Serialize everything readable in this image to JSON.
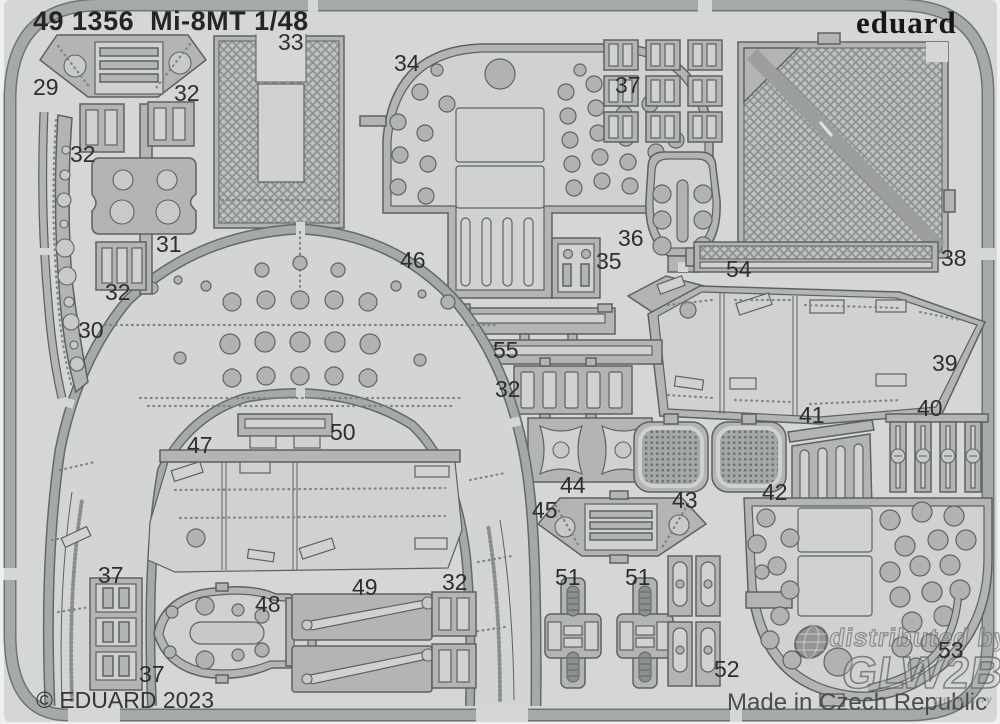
{
  "header": {
    "catalog": "49 1356",
    "product": "Mi-8MT 1/48",
    "brand": "eduard"
  },
  "footer": {
    "copyright": "© EDUARD 2023",
    "made_in": "Made in Czech Republic"
  },
  "watermark": {
    "line1": "distributed by",
    "glow_left": "GL",
    "glow_right": "W2B",
    "country": "germany"
  },
  "colors": {
    "sheet": "#d5d7d6",
    "metal": "#b2b5b3",
    "panel": "#d0d2d1",
    "frame": "#a6aaa7",
    "mesh": "#8e9290",
    "text": "#2d2f2e"
  },
  "part_labels": [
    {
      "text": "29"
    },
    {
      "text": "32"
    },
    {
      "text": "33"
    },
    {
      "text": "34"
    },
    {
      "text": "37"
    },
    {
      "text": "38"
    },
    {
      "text": "32"
    },
    {
      "text": "31"
    },
    {
      "text": "32"
    },
    {
      "text": "30"
    },
    {
      "text": "46"
    },
    {
      "text": "36"
    },
    {
      "text": "35"
    },
    {
      "text": "54"
    },
    {
      "text": "55"
    },
    {
      "text": "39"
    },
    {
      "text": "32"
    },
    {
      "text": "41"
    },
    {
      "text": "40"
    },
    {
      "text": "44"
    },
    {
      "text": "43"
    },
    {
      "text": "42"
    },
    {
      "text": "45"
    },
    {
      "text": "47"
    },
    {
      "text": "50"
    },
    {
      "text": "37"
    },
    {
      "text": "48"
    },
    {
      "text": "49"
    },
    {
      "text": "32"
    },
    {
      "text": "51"
    },
    {
      "text": "51"
    },
    {
      "text": "37"
    },
    {
      "text": "52"
    },
    {
      "text": "53"
    }
  ]
}
